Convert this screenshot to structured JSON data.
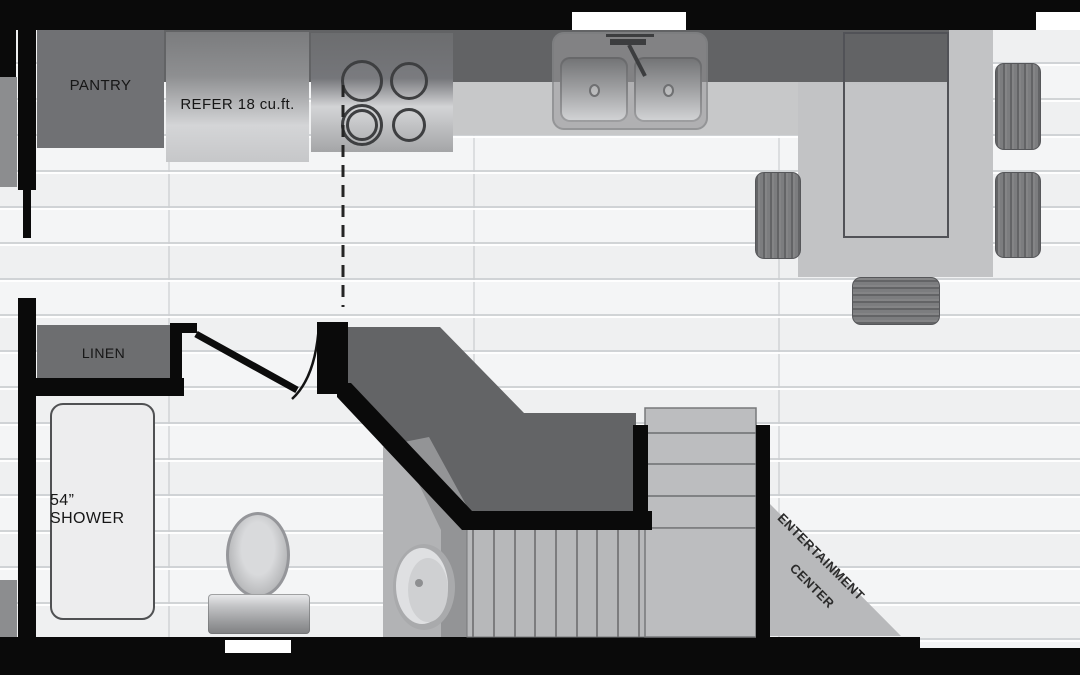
{
  "meta": {
    "document_type": "travel trailer / tiny home floor plan, top-down monochrome"
  },
  "labels": {
    "pantry": "PANTRY",
    "refer": "REFER 18 cu.ft.",
    "linen": "LINEN",
    "shower": "54” SHOWER",
    "entertainment_line1": "ENTERTAINMENT",
    "entertainment_line2": "CENTER"
  },
  "fixtures": [
    "pantry-cabinet",
    "refrigerator",
    "cooktop-4-burners",
    "double-bowl-kitchen-sink",
    "dining-table",
    "dining-chairs-x4",
    "linen-closet",
    "bathroom-door-swing",
    "shower-54-inch",
    "toilet",
    "bathroom-vanity-sink",
    "wardrobe-angled-cabinet",
    "staircase-upper-flight",
    "staircase-landing",
    "staircase-lower-flight",
    "entertainment-center-corner"
  ],
  "colors": {
    "wall_black": "#0a0a0a",
    "floor_white": "#f4f5f6",
    "counter_dark": "#626365",
    "counter_light": "#c7c8c9",
    "cabinet_gray": "#707174",
    "stairs_gray": "#bcbdbf",
    "wardrobe_gray": "#636466",
    "text_dark": "#161616"
  }
}
